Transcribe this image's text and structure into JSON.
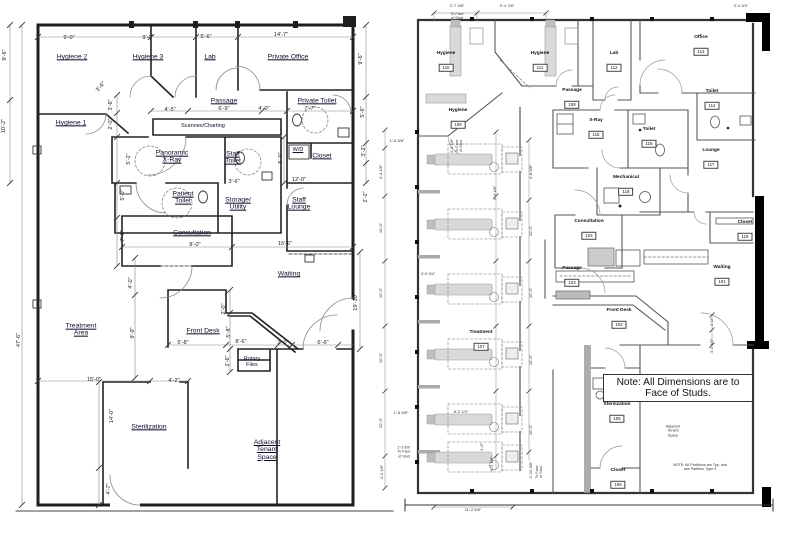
{
  "document": {
    "kind": "dental-office-floor-plans-side-by-side",
    "background": "#ffffff",
    "ink_color": "#222222"
  },
  "left_plan": {
    "labels": [
      {
        "lines": [
          "Hygiene 2"
        ],
        "x": 72,
        "y": 57
      },
      {
        "lines": [
          "Hygiene 3"
        ],
        "x": 148,
        "y": 57
      },
      {
        "lines": [
          "Lab"
        ],
        "x": 210,
        "y": 57
      },
      {
        "lines": [
          "Private Office"
        ],
        "x": 288,
        "y": 57
      },
      {
        "lines": [
          "Hygiene 1"
        ],
        "x": 71,
        "y": 123
      },
      {
        "lines": [
          "Passage"
        ],
        "x": 224,
        "y": 101
      },
      {
        "lines": [
          "Private Toilet"
        ],
        "x": 317,
        "y": 101
      },
      {
        "lines": [
          "Scannex/Charting"
        ],
        "x": 203,
        "y": 127,
        "u": false,
        "s": true
      },
      {
        "lines": [
          "Panoramic",
          "X-Ray"
        ],
        "x": 172,
        "y": 157
      },
      {
        "lines": [
          "Staff",
          "Toilet"
        ],
        "x": 233,
        "y": 158
      },
      {
        "lines": [
          "W/D"
        ],
        "x": 298,
        "y": 151,
        "s": true
      },
      {
        "lines": [
          "Closet"
        ],
        "x": 322,
        "y": 156
      },
      {
        "lines": [
          "Patient",
          "Toilet"
        ],
        "x": 183,
        "y": 198
      },
      {
        "lines": [
          "Storage/",
          "Utility"
        ],
        "x": 238,
        "y": 204
      },
      {
        "lines": [
          "Staff",
          "Lounge"
        ],
        "x": 299,
        "y": 204
      },
      {
        "lines": [
          "Consultation"
        ],
        "x": 192,
        "y": 233
      },
      {
        "lines": [
          "Waiting"
        ],
        "x": 289,
        "y": 274
      },
      {
        "lines": [
          "Treatment",
          "Area"
        ],
        "x": 81,
        "y": 330
      },
      {
        "lines": [
          "Front Desk"
        ],
        "x": 203,
        "y": 331
      },
      {
        "lines": [
          "Rotary",
          "Files"
        ],
        "x": 252,
        "y": 363,
        "u": false,
        "s": true
      },
      {
        "lines": [
          "Sterilization"
        ],
        "x": 149,
        "y": 427
      },
      {
        "lines": [
          "Adjacent",
          "Tenant",
          "Space"
        ],
        "x": 267,
        "y": 450
      }
    ],
    "dims": [
      {
        "t": "9'-0\"",
        "x": 69,
        "y": 38
      },
      {
        "t": "9'-0\"",
        "x": 148,
        "y": 38
      },
      {
        "t": "5'-6\"",
        "x": 206,
        "y": 37
      },
      {
        "t": "14'-7\"",
        "x": 281,
        "y": 35
      },
      {
        "t": "9'-6\"",
        "x": 5,
        "y": 55,
        "r": -90
      },
      {
        "t": "10'-2\"",
        "x": 4,
        "y": 126,
        "r": -90
      },
      {
        "t": "47'-6\"",
        "x": 19,
        "y": 340,
        "r": -90
      },
      {
        "t": "3'-6\"",
        "x": 101,
        "y": 87,
        "r": -50
      },
      {
        "t": "3'-6\"",
        "x": 111,
        "y": 105,
        "r": -90
      },
      {
        "t": "2'-0\"",
        "x": 111,
        "y": 124,
        "r": -90
      },
      {
        "t": "5'-2\"",
        "x": 129,
        "y": 159,
        "r": -90
      },
      {
        "t": "5'-0\"",
        "x": 123,
        "y": 195,
        "r": -90
      },
      {
        "t": "7'-3\"",
        "x": 123,
        "y": 236,
        "r": -90
      },
      {
        "t": "4'-5\"",
        "x": 170,
        "y": 110
      },
      {
        "t": "6'-9\"",
        "x": 224,
        "y": 109
      },
      {
        "t": "4'-0\"",
        "x": 264,
        "y": 109
      },
      {
        "t": "7'-7\"",
        "x": 310,
        "y": 109
      },
      {
        "t": "5'-0\"",
        "x": 281,
        "y": 158,
        "r": -90
      },
      {
        "t": "3'-6\"",
        "x": 234,
        "y": 182
      },
      {
        "t": "12'-0\"",
        "x": 299,
        "y": 180
      },
      {
        "t": "8'-0\"",
        "x": 195,
        "y": 245
      },
      {
        "t": "15'-6\"",
        "x": 285,
        "y": 244
      },
      {
        "t": "4'-0\"",
        "x": 131,
        "y": 283,
        "r": -90
      },
      {
        "t": "9'-9\"",
        "x": 133,
        "y": 333,
        "r": -90
      },
      {
        "t": "2'-0\"",
        "x": 224,
        "y": 309,
        "r": -90
      },
      {
        "t": "5'-8\"",
        "x": 229,
        "y": 332,
        "r": -90
      },
      {
        "t": "2'-6\"",
        "x": 228,
        "y": 361,
        "r": -90
      },
      {
        "t": "5'-8\"",
        "x": 183,
        "y": 343
      },
      {
        "t": "8'-6\"",
        "x": 241,
        "y": 342
      },
      {
        "t": "2'-0\"",
        "x": 283,
        "y": 343
      },
      {
        "t": "6'-6\"",
        "x": 323,
        "y": 343
      },
      {
        "t": "15'-0\"",
        "x": 94,
        "y": 380
      },
      {
        "t": "4'-2\"",
        "x": 174,
        "y": 381
      },
      {
        "t": "14'-0\"",
        "x": 112,
        "y": 416,
        "r": -90
      },
      {
        "t": "4'-7\"",
        "x": 109,
        "y": 489,
        "r": -90
      },
      {
        "t": "9'-6\"",
        "x": 361,
        "y": 59,
        "r": -90
      },
      {
        "t": "5'-6\"",
        "x": 363,
        "y": 112,
        "r": -90
      },
      {
        "t": "3'-2\"",
        "x": 364,
        "y": 151,
        "r": -90
      },
      {
        "t": "2'-2\"",
        "x": 366,
        "y": 197,
        "r": -90
      },
      {
        "t": "19'-10\"",
        "x": 356,
        "y": 302,
        "r": -90
      }
    ]
  },
  "right_plan": {
    "rooms": [
      {
        "name": "Hygiene",
        "num": "110",
        "x": 446,
        "y": 62
      },
      {
        "name": "Hygiene",
        "num": "111",
        "x": 540,
        "y": 62
      },
      {
        "name": "Lab",
        "num": "112",
        "x": 614,
        "y": 62
      },
      {
        "name": "Office",
        "num": "113",
        "x": 701,
        "y": 46
      },
      {
        "name": "Toilet",
        "num": "114",
        "x": 712,
        "y": 100
      },
      {
        "name": "Passage",
        "num": "108",
        "x": 572,
        "y": 99
      },
      {
        "name": "Hygiene",
        "num": "109",
        "x": 458,
        "y": 119
      },
      {
        "name": "X-Ray",
        "num": "115",
        "x": 596,
        "y": 129
      },
      {
        "name": "Toilet",
        "num": "116",
        "x": 649,
        "y": 138
      },
      {
        "name": "Lounge",
        "num": "117",
        "x": 711,
        "y": 159
      },
      {
        "name": "Mechanical",
        "num": "118",
        "x": 626,
        "y": 186
      },
      {
        "name": "Consultation",
        "num": "104",
        "x": 589,
        "y": 230
      },
      {
        "name": "Closet",
        "num": "119",
        "x": 745,
        "y": 231
      },
      {
        "name": "Passage",
        "num": "103",
        "x": 572,
        "y": 277
      },
      {
        "name": "Waiting",
        "num": "101",
        "x": 722,
        "y": 276
      },
      {
        "name": "Front Desk",
        "num": "102",
        "x": 619,
        "y": 319
      },
      {
        "name": "Treatment",
        "num": "107",
        "x": 481,
        "y": 341
      },
      {
        "name": "Sterilization",
        "num": "105",
        "x": 617,
        "y": 413
      },
      {
        "name": "Closet",
        "num": "106",
        "x": 618,
        "y": 479
      }
    ],
    "dims": [
      {
        "t": "3'-7 3/8\"",
        "x": 457,
        "y": 6
      },
      {
        "t": "9'-4 7/8\"",
        "x": 507,
        "y": 6
      },
      {
        "t": "3'-4 3/4\"",
        "x": 741,
        "y": 6
      },
      {
        "t": "1'-6 5/8\"",
        "x": 397,
        "y": 141
      },
      {
        "t": "4'-4 1/8\"",
        "x": 381,
        "y": 172,
        "r": -90
      },
      {
        "t": "10'-0\"",
        "x": 381,
        "y": 228,
        "r": -90
      },
      {
        "t": "10'-0\"",
        "x": 381,
        "y": 293,
        "r": -90
      },
      {
        "t": "10'-0\"",
        "x": 381,
        "y": 358,
        "r": -90
      },
      {
        "t": "10'-0\"",
        "x": 381,
        "y": 423,
        "r": -90
      },
      {
        "t": "4'-2 1/8\"",
        "x": 382,
        "y": 472,
        "r": -90
      },
      {
        "t": "1'-6 5/8\"",
        "x": 401,
        "y": 413
      },
      {
        "t": "3'-4 1/8\"",
        "x": 452,
        "y": 146,
        "r": -90
      },
      {
        "t": "9'-3 1/8\"",
        "x": 495,
        "y": 193,
        "r": -90
      },
      {
        "t": "4'-8 5/8\"",
        "x": 531,
        "y": 172,
        "r": -90
      },
      {
        "t": "10'-0\"",
        "x": 531,
        "y": 231,
        "r": -90
      },
      {
        "t": "10'-0\"",
        "x": 531,
        "y": 293,
        "r": -90
      },
      {
        "t": "10'-0\"",
        "x": 531,
        "y": 360,
        "r": -90
      },
      {
        "t": "10'-0\"",
        "x": 531,
        "y": 430,
        "r": -90
      },
      {
        "t": "4'-9 3/4\"",
        "x": 428,
        "y": 274
      },
      {
        "t": "8'-2 1/4\"",
        "x": 461,
        "y": 412
      },
      {
        "t": "1'-0\"",
        "x": 482,
        "y": 447,
        "r": -90
      },
      {
        "t": "9'-3 1/8\"",
        "x": 492,
        "y": 464,
        "r": -90
      },
      {
        "t": "2'-10 3/8\"",
        "x": 531,
        "y": 470,
        "r": -90
      },
      {
        "t": "11'-2 5/8\"",
        "x": 473,
        "y": 510
      },
      {
        "t": "2'-0\"",
        "x": 712,
        "y": 322,
        "r": -90
      },
      {
        "t": "4'-0 1/2\"",
        "x": 712,
        "y": 346,
        "r": -90
      }
    ],
    "texts": [
      {
        "lines": [
          "To Face",
          "of Stud"
        ],
        "x": 457,
        "y": 16
      },
      {
        "lines": [
          "1'-3 5/8\"",
          "To Face",
          "of Stud"
        ],
        "x": 404,
        "y": 452
      },
      {
        "lines": [
          "To Face",
          "of Stud"
        ],
        "x": 539,
        "y": 472,
        "r": -90
      },
      {
        "lines": [
          "To Face",
          "of Stud"
        ],
        "x": 459,
        "y": 146,
        "r": -90
      },
      {
        "lines": [
          "Adjacent",
          "Tenant",
          "Space"
        ],
        "x": 673,
        "y": 431
      },
      {
        "lines": [
          "NOTE: All Partitions are Typ. and",
          "use Partition Type 4"
        ],
        "x": 700,
        "y": 467
      }
    ],
    "note": "Note: All Dimensions are to Face of Studs."
  }
}
